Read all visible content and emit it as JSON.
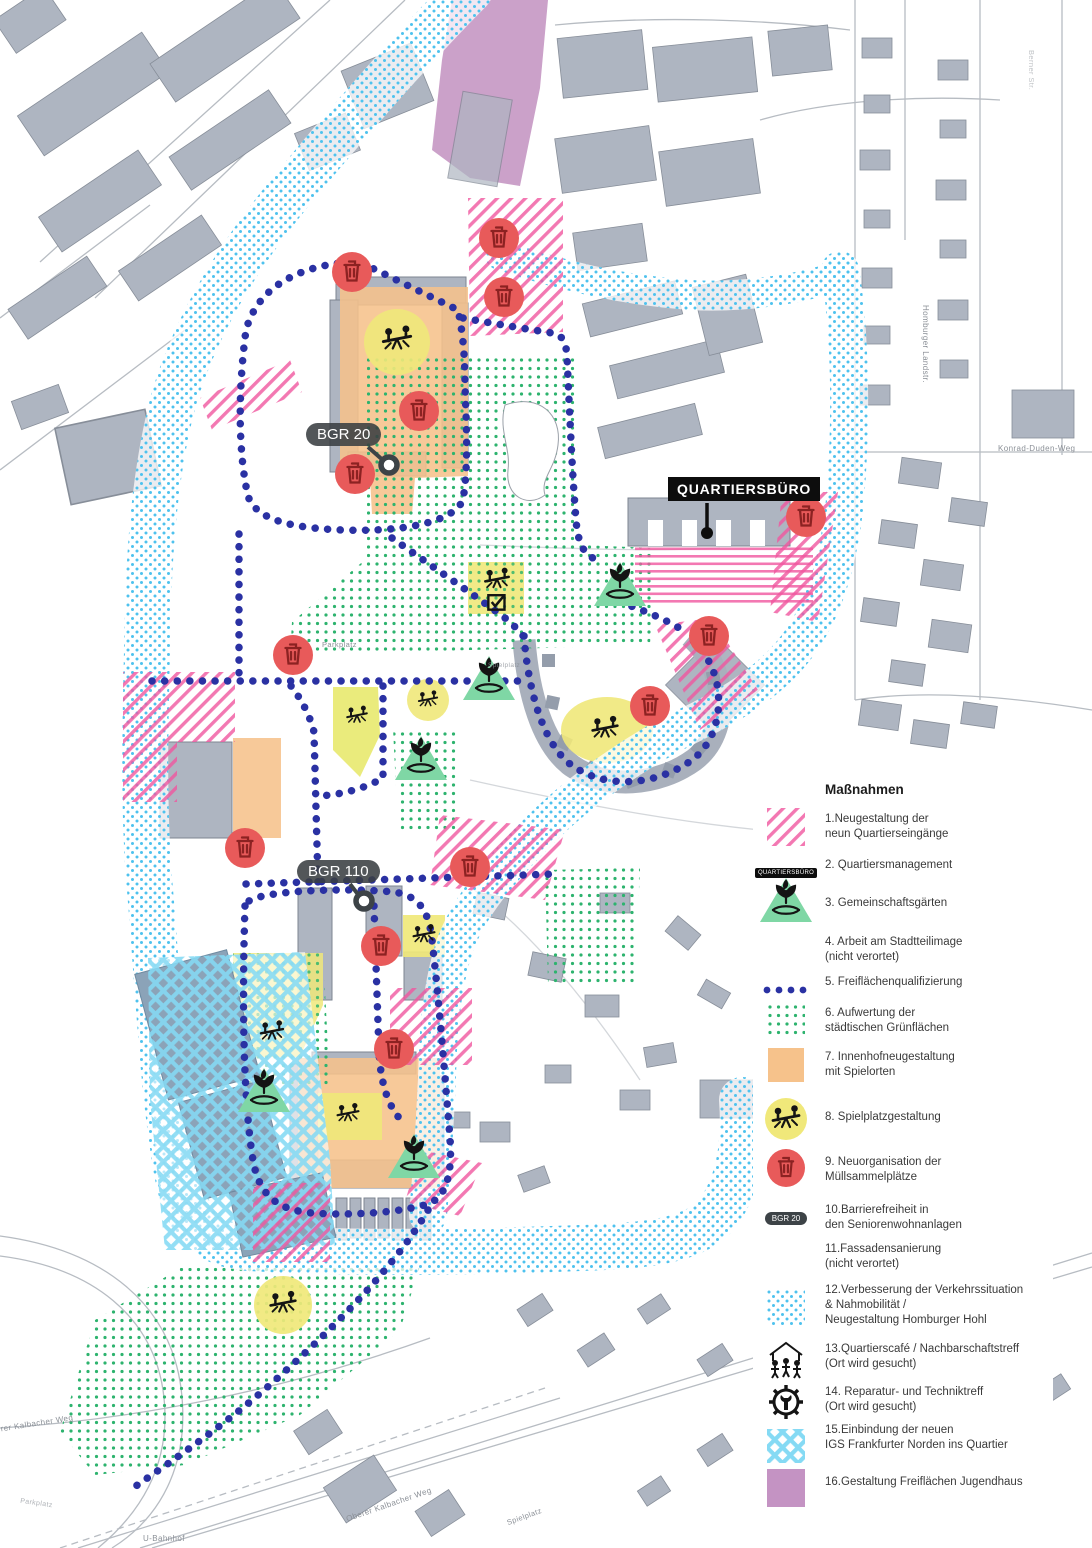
{
  "map": {
    "callouts": {
      "bgr20": "BGR 20",
      "bgr110": "BGR 110",
      "quartiersbuero": "QUARTIERSBÜRO"
    },
    "street_labels": {
      "parkplatz_mid": "Parkplatz",
      "parkplatz_bottom_left": "Parkplatz",
      "spielplatz_mid": "Spielplatz",
      "spielplatz_bottom": "Spielplatz",
      "u_bahnhof": "U-Bahnhof",
      "homburger_landstr": "Homburger Landstr.",
      "konrad_duden_weg": "Konrad-Duden-Weg",
      "oberer_kalbacher_weg_left": "Oberer Kalbacher Weg",
      "oberer_kalbacher_weg_bottom": "Oberer Kalbacher Weg",
      "berner_str": "Berner Str."
    }
  },
  "legend": {
    "title": "Maßnahmen",
    "items": [
      {
        "num": "1.",
        "label": "Neugestaltung der\nneun Quartierseingänge",
        "symbol": "pink-hatch-swatch"
      },
      {
        "num": "2.",
        "label": "Quartiersmanagement",
        "symbol": "quartiersbuero-pill",
        "symbol_text": "QUARTIERSBÜRO"
      },
      {
        "num": "3.",
        "label": "Gemeinschaftsgärten",
        "symbol": "garden-triangle"
      },
      {
        "num": "4.",
        "label": "Arbeit am Stadtteilimage\n(nicht verortet)",
        "symbol": "none"
      },
      {
        "num": "5.",
        "label": "Freiflächenqualifizierung",
        "symbol": "blue-dotted-line"
      },
      {
        "num": "6.",
        "label": "Aufwertung der\nstädtischen Grünflächen",
        "symbol": "green-dots-swatch"
      },
      {
        "num": "7.",
        "label": "Innenhofneugestaltung\nmit Spielorten",
        "symbol": "orange-swatch"
      },
      {
        "num": "8.",
        "label": "Spielplatzgestaltung",
        "symbol": "playground-circle"
      },
      {
        "num": "9.",
        "label": "Neuorganisation der\nMüllsammelplätze",
        "symbol": "trash-circle"
      },
      {
        "num": "10.",
        "label": "Barrierefreiheit in\nden Seniorenwohnanlagen",
        "symbol": "bgr-pill",
        "symbol_text": "BGR 20"
      },
      {
        "num": "11.",
        "label": "Fassadensanierung\n(nicht verortet)",
        "symbol": "none"
      },
      {
        "num": "12.",
        "label": "Verbesserung der Verkehrssituation\n& Nahmobilität /\nNeugestaltung Homburger Hohl",
        "symbol": "cyan-dots-swatch"
      },
      {
        "num": "13.",
        "label": "Quartierscafé / Nachbarschaftstreff\n(Ort wird gesucht)",
        "symbol": "house-people-icon"
      },
      {
        "num": "14.",
        "label": "Reparatur- und Techniktreff\n(Ort wird gesucht)",
        "symbol": "gear-wrench-icon"
      },
      {
        "num": "15.",
        "label": "Einbindung der neuen\nIGS Frankfurter Norden ins Quartier",
        "symbol": "cyan-check-swatch"
      },
      {
        "num": "16.",
        "label": "Gestaltung Freiflächen Jugendhaus",
        "symbol": "purple-swatch"
      }
    ]
  },
  "colors": {
    "pink": "#f0569f",
    "navy_dots": "#2a31a3",
    "cyan_dots": "#4ec2ee",
    "green_dots": "#2db36e",
    "orange": "#f6c28b",
    "yellow": "#f0e87a",
    "red_marker": "#e85a5a",
    "green_triangle": "#7fd7a5",
    "purple": "#bf8cbd",
    "building_gray": "#aeb5c1"
  }
}
